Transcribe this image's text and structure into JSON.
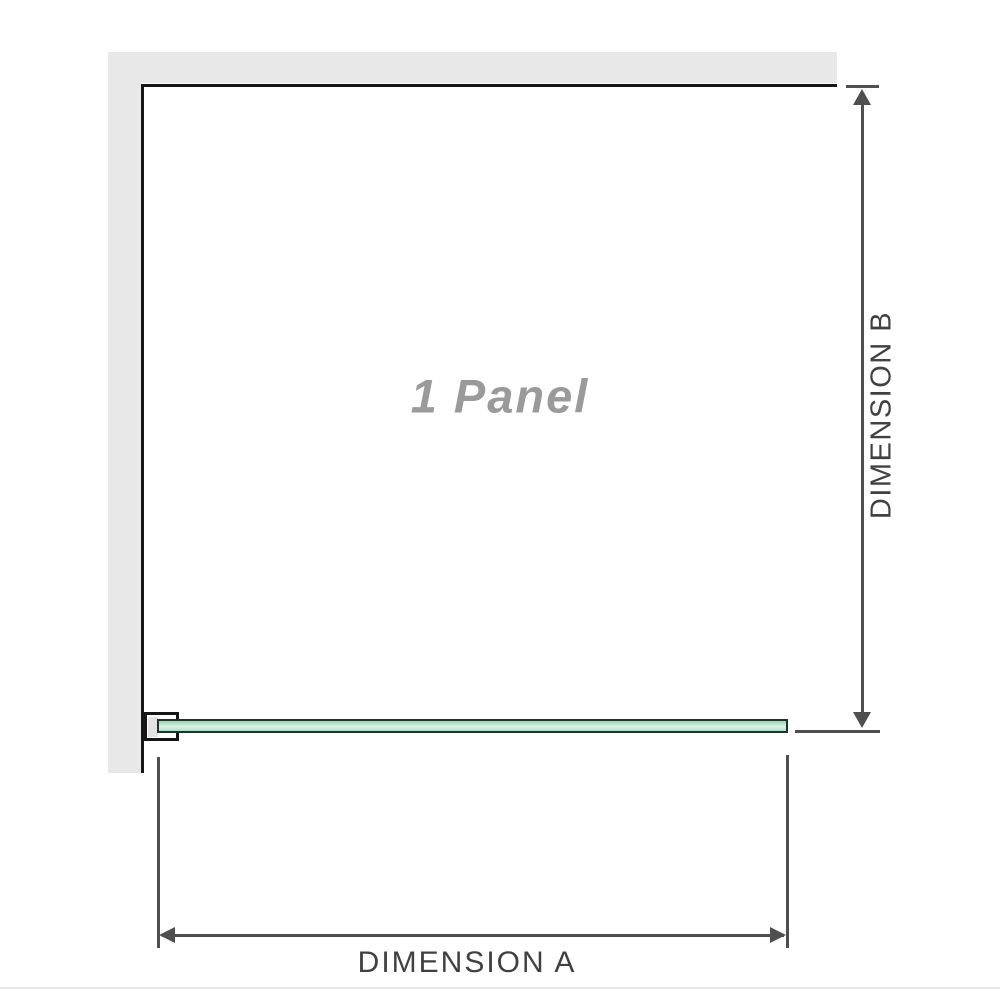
{
  "labels": {
    "panel": "1 Panel",
    "dimension_a": "DIMENSION A",
    "dimension_b": "DIMENSION B"
  },
  "colors": {
    "wall": "#e8e8e8",
    "outline": "#161616",
    "dimension": "#4f4f4f",
    "glass_border": "#1c3527",
    "glass_mid": "#97d2b2",
    "glass_mid2": "#aadec4",
    "glass_light": "#e0f3e9",
    "label_gray": "#9a9a9a",
    "text_dark": "#414141"
  }
}
